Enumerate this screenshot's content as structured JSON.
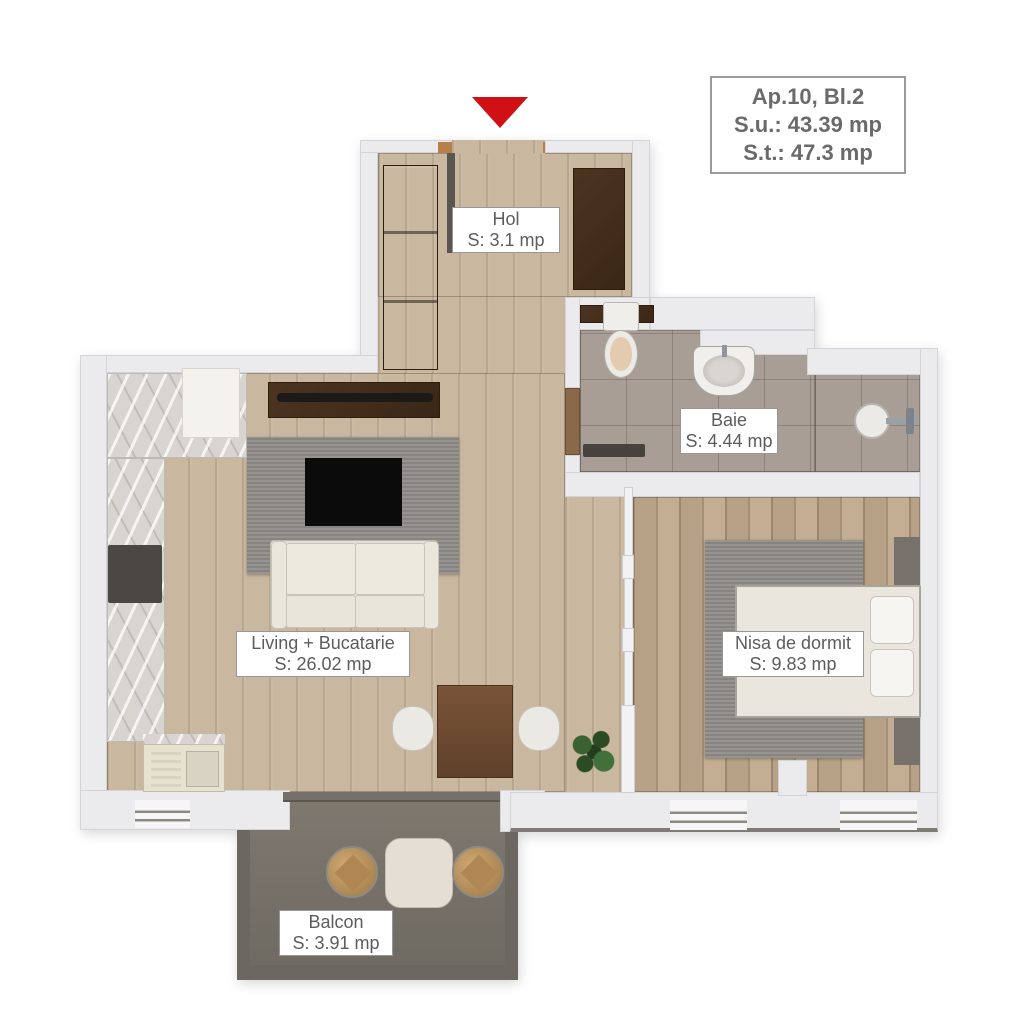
{
  "title_box": {
    "apartment": "Ap.10, Bl.2",
    "useful_area": "S.u.: 43.39 mp",
    "total_area": "S.t.: 47.3 mp"
  },
  "rooms": [
    {
      "name": "Hol",
      "area": "S: 3.1 mp"
    },
    {
      "name": "Baie",
      "area": "S: 4.44 mp"
    },
    {
      "name": "Living + Bucatarie",
      "area": "S: 26.02 mp"
    },
    {
      "name": "Nisa de dormit",
      "area": "S: 9.83 mp"
    },
    {
      "name": "Balcon",
      "area": "S: 3.91 mp"
    }
  ],
  "icons": {
    "entrance": "red-arrow-down"
  },
  "colors": {
    "entrance_arrow": "#cf1015",
    "wall": "#ebebee",
    "wood_floor": "#c9b79f",
    "bedroom_floor": "#c3ae93",
    "bath_tile": "#a89e95",
    "balcony_floor": "#7b756d",
    "furniture_dark_wood": "#3f2a1d",
    "label_text": "#5c5c5c",
    "label_border": "#979797",
    "title_text": "#6a6a6a"
  }
}
